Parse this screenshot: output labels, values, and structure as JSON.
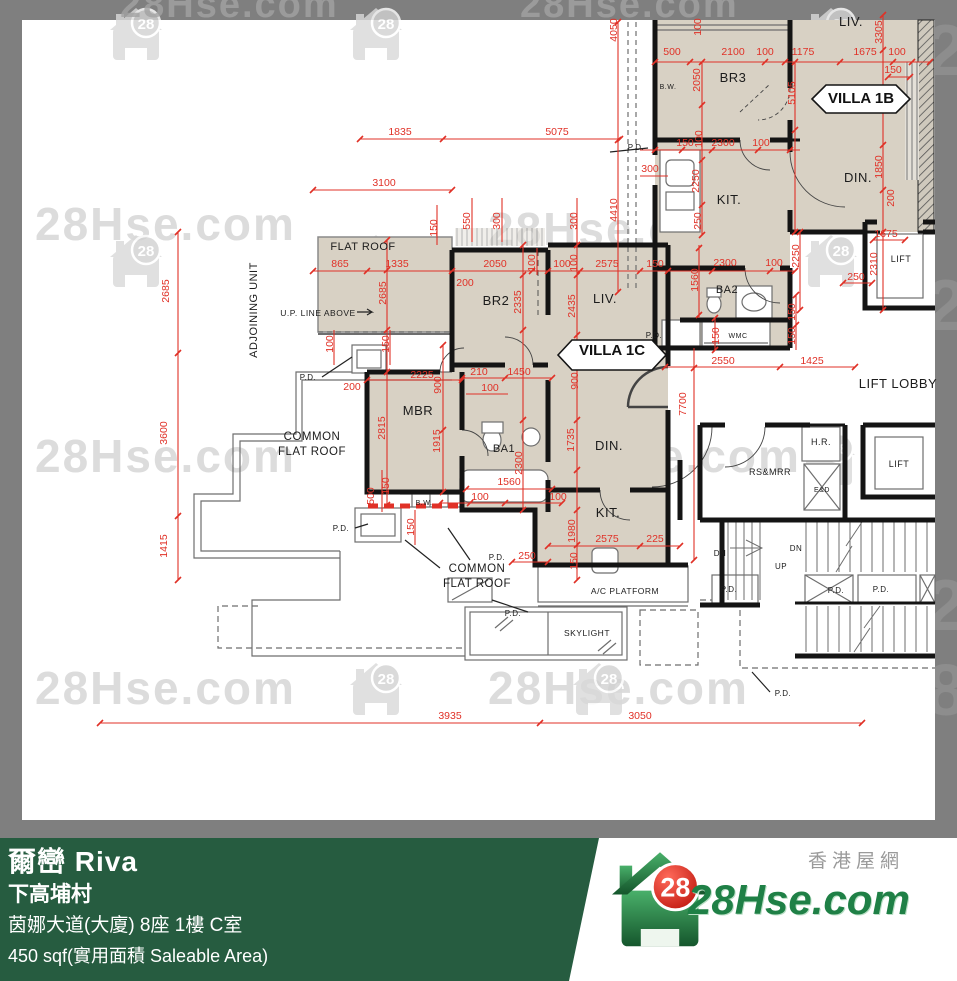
{
  "watermark": {
    "text": "28Hse.com",
    "badge": "28",
    "strip_digit_a": "2",
    "strip_digit_b": "8"
  },
  "plan": {
    "villa_tags": [
      {
        "t": "VILLA 1C",
        "x": 612,
        "y": 355
      },
      {
        "t": "VILLA 1B",
        "x": 861,
        "y": 103
      }
    ],
    "labels": [
      {
        "t": "FLAT ROOF",
        "x": 363,
        "y": 250,
        "fs": 11
      },
      {
        "t": "BR2",
        "x": 496,
        "y": 305,
        "fs": 13
      },
      {
        "t": "LIV.",
        "x": 605,
        "y": 303,
        "fs": 13
      },
      {
        "t": "MBR",
        "x": 418,
        "y": 415,
        "fs": 13
      },
      {
        "t": "BA1",
        "x": 504,
        "y": 452,
        "fs": 11
      },
      {
        "t": "DIN.",
        "x": 609,
        "y": 450,
        "fs": 13
      },
      {
        "t": "KIT.",
        "x": 608,
        "y": 517,
        "fs": 13
      },
      {
        "t": "BR3",
        "x": 733,
        "y": 82,
        "fs": 13
      },
      {
        "t": "KIT.",
        "x": 729,
        "y": 204,
        "fs": 13
      },
      {
        "t": "BA2",
        "x": 727,
        "y": 293,
        "fs": 11
      },
      {
        "t": "WMC",
        "x": 738,
        "y": 338,
        "fs": 7
      },
      {
        "t": "DIN.",
        "x": 858,
        "y": 182,
        "fs": 13
      },
      {
        "t": "LIV.",
        "x": 851,
        "y": 26,
        "fs": 13
      },
      {
        "t": "LIFT LOBBY",
        "x": 898,
        "y": 388,
        "fs": 13
      },
      {
        "t": "LIFT",
        "x": 901,
        "y": 262,
        "fs": 9
      },
      {
        "t": "LIFT",
        "x": 899,
        "y": 467,
        "fs": 9
      },
      {
        "t": "H.R.",
        "x": 821,
        "y": 445,
        "fs": 9
      },
      {
        "t": "RS&MRR",
        "x": 770,
        "y": 475,
        "fs": 9
      },
      {
        "t": "E&D",
        "x": 822,
        "y": 492,
        "fs": 7
      },
      {
        "t": "B.W.",
        "x": 668,
        "y": 89,
        "fs": 7
      },
      {
        "t": "B.W.",
        "x": 424,
        "y": 505,
        "fs": 7
      },
      {
        "t": "U.P. LINE ABOVE",
        "x": 318,
        "y": 316,
        "fs": 8.5
      },
      {
        "t": "ADJOINING UNIT",
        "x": 257,
        "y": 310,
        "fs": 11,
        "r": 1
      },
      {
        "t": "COMMON",
        "x": 312,
        "y": 440,
        "fs": 11.5
      },
      {
        "t": "FLAT ROOF",
        "x": 312,
        "y": 455,
        "fs": 11.5
      },
      {
        "t": "COMMON",
        "x": 477,
        "y": 572,
        "fs": 11.5
      },
      {
        "t": "FLAT ROOF",
        "x": 477,
        "y": 587,
        "fs": 11.5
      },
      {
        "t": "A/C PLATFORM",
        "x": 625,
        "y": 594,
        "fs": 8.5
      },
      {
        "t": "SKYLIGHT",
        "x": 587,
        "y": 636,
        "fs": 8.5
      },
      {
        "t": "DN",
        "x": 720,
        "y": 556,
        "fs": 8
      },
      {
        "t": "DN",
        "x": 796,
        "y": 551,
        "fs": 8
      },
      {
        "t": "UP",
        "x": 781,
        "y": 569,
        "fs": 8
      },
      {
        "t": "P.D.",
        "x": 308,
        "y": 380,
        "fs": 8
      },
      {
        "t": "P.D.",
        "x": 341,
        "y": 531,
        "fs": 8
      },
      {
        "t": "P.D.",
        "x": 497,
        "y": 560,
        "fs": 8
      },
      {
        "t": "P.D.",
        "x": 513,
        "y": 616,
        "fs": 8
      },
      {
        "t": "P.D.",
        "x": 636,
        "y": 150,
        "fs": 8
      },
      {
        "t": "P.D.",
        "x": 654,
        "y": 338,
        "fs": 8
      },
      {
        "t": "P.D.",
        "x": 729,
        "y": 592,
        "fs": 8
      },
      {
        "t": "P.D.",
        "x": 836,
        "y": 593,
        "fs": 8
      },
      {
        "t": "P.D.",
        "x": 881,
        "y": 592,
        "fs": 8
      },
      {
        "t": "P.D.",
        "x": 783,
        "y": 696,
        "fs": 8
      }
    ],
    "dims": [
      {
        "t": "1835",
        "x": 400,
        "y": 135
      },
      {
        "t": "5075",
        "x": 557,
        "y": 135
      },
      {
        "t": "3100",
        "x": 384,
        "y": 186
      },
      {
        "t": "550",
        "x": 470,
        "y": 221,
        "r": 1
      },
      {
        "t": "300",
        "x": 500,
        "y": 221,
        "r": 1
      },
      {
        "t": "300",
        "x": 577,
        "y": 221,
        "r": 1
      },
      {
        "t": "150",
        "x": 437,
        "y": 228,
        "r": 1
      },
      {
        "t": "865",
        "x": 340,
        "y": 267
      },
      {
        "t": "1335",
        "x": 397,
        "y": 267
      },
      {
        "t": "2050",
        "x": 495,
        "y": 267
      },
      {
        "t": "100",
        "x": 535,
        "y": 263,
        "r": 1
      },
      {
        "t": "100",
        "x": 562,
        "y": 267
      },
      {
        "t": "100",
        "x": 577,
        "y": 263,
        "r": 1
      },
      {
        "t": "2575",
        "x": 607,
        "y": 267
      },
      {
        "t": "150",
        "x": 655,
        "y": 267
      },
      {
        "t": "200",
        "x": 465,
        "y": 286
      },
      {
        "t": "2685",
        "x": 386,
        "y": 293,
        "r": 1
      },
      {
        "t": "2335",
        "x": 521,
        "y": 302,
        "r": 1
      },
      {
        "t": "2435",
        "x": 575,
        "y": 306,
        "r": 1
      },
      {
        "t": "100",
        "x": 333,
        "y": 344,
        "r": 1
      },
      {
        "t": "150",
        "x": 389,
        "y": 344,
        "r": 1
      },
      {
        "t": "2685",
        "x": 169,
        "y": 291,
        "r": 1
      },
      {
        "t": "3600",
        "x": 167,
        "y": 433,
        "r": 1
      },
      {
        "t": "1415",
        "x": 167,
        "y": 546,
        "r": 1
      },
      {
        "t": "4050",
        "x": 617,
        "y": 30,
        "r": 1
      },
      {
        "t": "4410",
        "x": 617,
        "y": 210,
        "r": 1
      },
      {
        "t": "200",
        "x": 352,
        "y": 390
      },
      {
        "t": "2225",
        "x": 422,
        "y": 378
      },
      {
        "t": "900",
        "x": 441,
        "y": 385,
        "r": 1
      },
      {
        "t": "210",
        "x": 479,
        "y": 375
      },
      {
        "t": "1450",
        "x": 519,
        "y": 375
      },
      {
        "t": "100",
        "x": 490,
        "y": 391
      },
      {
        "t": "900",
        "x": 578,
        "y": 381,
        "r": 1
      },
      {
        "t": "2815",
        "x": 385,
        "y": 428,
        "r": 1
      },
      {
        "t": "1915",
        "x": 440,
        "y": 441,
        "r": 1
      },
      {
        "t": "2300",
        "x": 522,
        "y": 463,
        "r": 1
      },
      {
        "t": "1735",
        "x": 574,
        "y": 440,
        "r": 1
      },
      {
        "t": "1560",
        "x": 509,
        "y": 485
      },
      {
        "t": "100",
        "x": 480,
        "y": 500
      },
      {
        "t": "100",
        "x": 558,
        "y": 500
      },
      {
        "t": "500",
        "x": 374,
        "y": 496,
        "r": 1
      },
      {
        "t": "150",
        "x": 389,
        "y": 486,
        "r": 1
      },
      {
        "t": "150",
        "x": 414,
        "y": 527,
        "r": 1
      },
      {
        "t": "250",
        "x": 527,
        "y": 559
      },
      {
        "t": "1980",
        "x": 575,
        "y": 531,
        "r": 1
      },
      {
        "t": "150",
        "x": 577,
        "y": 561,
        "r": 1
      },
      {
        "t": "2575",
        "x": 607,
        "y": 542
      },
      {
        "t": "225",
        "x": 655,
        "y": 542
      },
      {
        "t": "3935",
        "x": 450,
        "y": 719
      },
      {
        "t": "3050",
        "x": 640,
        "y": 719
      },
      {
        "t": "100",
        "x": 701,
        "y": 27,
        "r": 1
      },
      {
        "t": "500",
        "x": 672,
        "y": 55
      },
      {
        "t": "2100",
        "x": 733,
        "y": 55
      },
      {
        "t": "100",
        "x": 765,
        "y": 55
      },
      {
        "t": "1175",
        "x": 803,
        "y": 55
      },
      {
        "t": "1675",
        "x": 865,
        "y": 55
      },
      {
        "t": "100",
        "x": 897,
        "y": 55
      },
      {
        "t": "150",
        "x": 893,
        "y": 73
      },
      {
        "t": "2050",
        "x": 700,
        "y": 80,
        "r": 1
      },
      {
        "t": "5105",
        "x": 795,
        "y": 93,
        "r": 1
      },
      {
        "t": "3305",
        "x": 882,
        "y": 32,
        "r": 1
      },
      {
        "t": "150",
        "x": 685,
        "y": 146
      },
      {
        "t": "100",
        "x": 702,
        "y": 139,
        "r": 1
      },
      {
        "t": "2300",
        "x": 723,
        "y": 146
      },
      {
        "t": "100",
        "x": 761,
        "y": 146
      },
      {
        "t": "300",
        "x": 650,
        "y": 172
      },
      {
        "t": "2250",
        "x": 699,
        "y": 181,
        "r": 1
      },
      {
        "t": "250",
        "x": 701,
        "y": 221,
        "r": 1
      },
      {
        "t": "1850",
        "x": 882,
        "y": 167,
        "r": 1
      },
      {
        "t": "200",
        "x": 894,
        "y": 198,
        "r": 1
      },
      {
        "t": "2250",
        "x": 799,
        "y": 256,
        "r": 1
      },
      {
        "t": "2300",
        "x": 725,
        "y": 266
      },
      {
        "t": "100",
        "x": 774,
        "y": 266
      },
      {
        "t": "1560",
        "x": 698,
        "y": 280,
        "r": 1
      },
      {
        "t": "150",
        "x": 795,
        "y": 312,
        "r": 1
      },
      {
        "t": "150",
        "x": 795,
        "y": 336,
        "r": 1
      },
      {
        "t": "150",
        "x": 719,
        "y": 336,
        "r": 1
      },
      {
        "t": "2550",
        "x": 723,
        "y": 364
      },
      {
        "t": "1425",
        "x": 812,
        "y": 364
      },
      {
        "t": "7700",
        "x": 686,
        "y": 404,
        "r": 1
      },
      {
        "t": "1675",
        "x": 886,
        "y": 237
      },
      {
        "t": "2310",
        "x": 877,
        "y": 264,
        "r": 1
      },
      {
        "t": "250",
        "x": 856,
        "y": 280
      }
    ]
  },
  "footer": {
    "title": "爾巒 Riva",
    "line2": "下高埔村",
    "line3": "茵娜大道(大廈) 8座 1樓 C室",
    "line4": "450 sqf(實用面積 Saleable Area)"
  },
  "logo": {
    "badge": "28",
    "site": "28Hse.com",
    "site_cn": "香港屋網"
  },
  "colors": {
    "room_fill": "#d8d1c4",
    "dim_red": "#e03127",
    "frame_gray": "#7f7f7f",
    "footer_green": "#265c40",
    "logo_green": "#1f8046",
    "logo_red": "#d6160c"
  }
}
